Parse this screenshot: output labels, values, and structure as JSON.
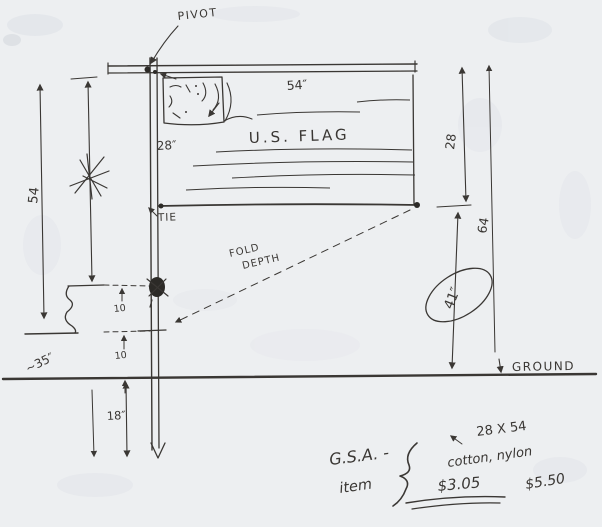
{
  "document": {
    "kind": "hand-drawn flag installation sketch on scanned paper"
  },
  "colors": {
    "paper": "#edeff1",
    "speckle": "#e2e5ea",
    "ink": "#3a3734",
    "ink_dark": "#2c2a27"
  },
  "labels": {
    "pivot": "PIVOT",
    "flag_width": "54″",
    "flag_name": "U.S. FLAG",
    "canton_width": "28″",
    "tie": "TIE",
    "fold_line1": "FOLD",
    "fold_line2": "DEPTH",
    "pole_height_left": "54",
    "flag_drop_right": "28",
    "total_height_right": "64",
    "drop_to_ground_circled": "41″",
    "ground": "GROUND",
    "gap_upper": "10",
    "gap_lower": "10",
    "wall_height": "~35″",
    "below_ground_depth": "18″",
    "note_org": "G.S.A. -",
    "note_item": "item",
    "note_size": "28 X 54",
    "note_material": "cotton, nylon",
    "note_price_cotton": "$3.05",
    "note_price_nylon": "$5.50"
  }
}
